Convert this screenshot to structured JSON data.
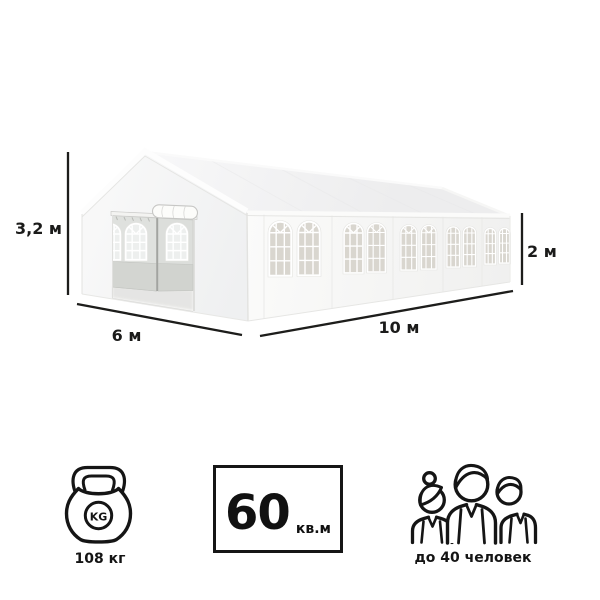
{
  "product_figure": {
    "type": "party-tent-illustration",
    "dimension_labels": {
      "height": "3,2 м",
      "front_width": "6 м",
      "side_length": "10 м",
      "wall_height": "2 м"
    }
  },
  "specs": {
    "weight": {
      "icon": "kettlebell-icon",
      "icon_text": "KG",
      "value_label": "108 кг"
    },
    "area": {
      "icon": "area-badge",
      "value": "60",
      "unit": "кв.м"
    },
    "capacity": {
      "icon": "people-group-icon",
      "value_label": "до 40 человек"
    }
  },
  "colors": {
    "dimension_line": "#1d1d1b",
    "icon_outline": "#151515",
    "tent_white": "#f6f7f7",
    "door_panel_gray": "#dcdedb",
    "window_pane": "#d9d6cf"
  }
}
